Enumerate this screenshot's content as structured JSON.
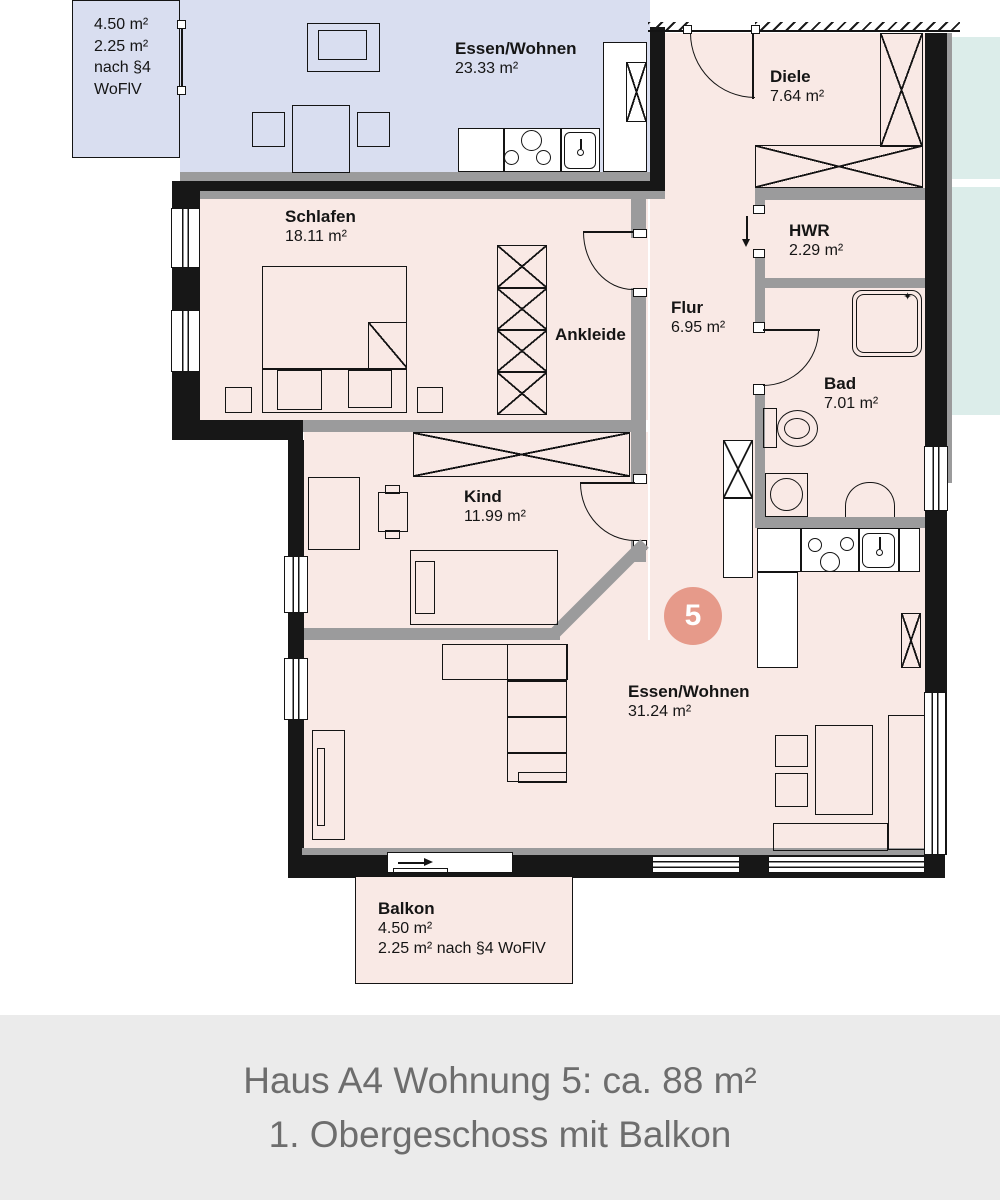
{
  "unit_badge": {
    "number": "5",
    "color": "#e69a8a"
  },
  "rooms": {
    "neighbor_balcony_lines": [
      "4.50 m²",
      "2.25 m²",
      "nach §4",
      "WoFlV"
    ],
    "neighbor_unit": {
      "name": "Essen/Wohnen",
      "area": "23.33 m²"
    },
    "diele": {
      "name": "Diele",
      "area": "7.64 m²"
    },
    "schlafen": {
      "name": "Schlafen",
      "area": "18.11 m²"
    },
    "ankleide": {
      "name": "Ankleide"
    },
    "flur": {
      "name": "Flur",
      "area": "6.95 m²"
    },
    "hwr": {
      "name": "HWR",
      "area": "2.29 m²"
    },
    "bad": {
      "name": "Bad",
      "area": "7.01 m²"
    },
    "kind": {
      "name": "Kind",
      "area": "11.99 m²"
    },
    "wohnen": {
      "name": "Essen/Wohnen",
      "area": "31.24 m²"
    },
    "balkon": {
      "name": "Balkon",
      "line1": "4.50 m²",
      "line2": "2.25 m² nach §4 WoFlV"
    }
  },
  "icons": {
    "shower_sparkle": "✦"
  },
  "footer": {
    "line1": "Haus A4 Wohnung 5: ca. 88 m²",
    "line2": "1. Obergeschoss mit Balkon"
  },
  "colors": {
    "floor_pink": "#f9e9e5",
    "neighbor_blue": "#d9def0",
    "neighbor_teal": "#dcedea",
    "wall_gray": "#9b9b9c",
    "wall_black": "#171717",
    "badge": "#e69a8a",
    "footer_bg": "#ebebeb",
    "footer_text": "#6d6d6d"
  }
}
